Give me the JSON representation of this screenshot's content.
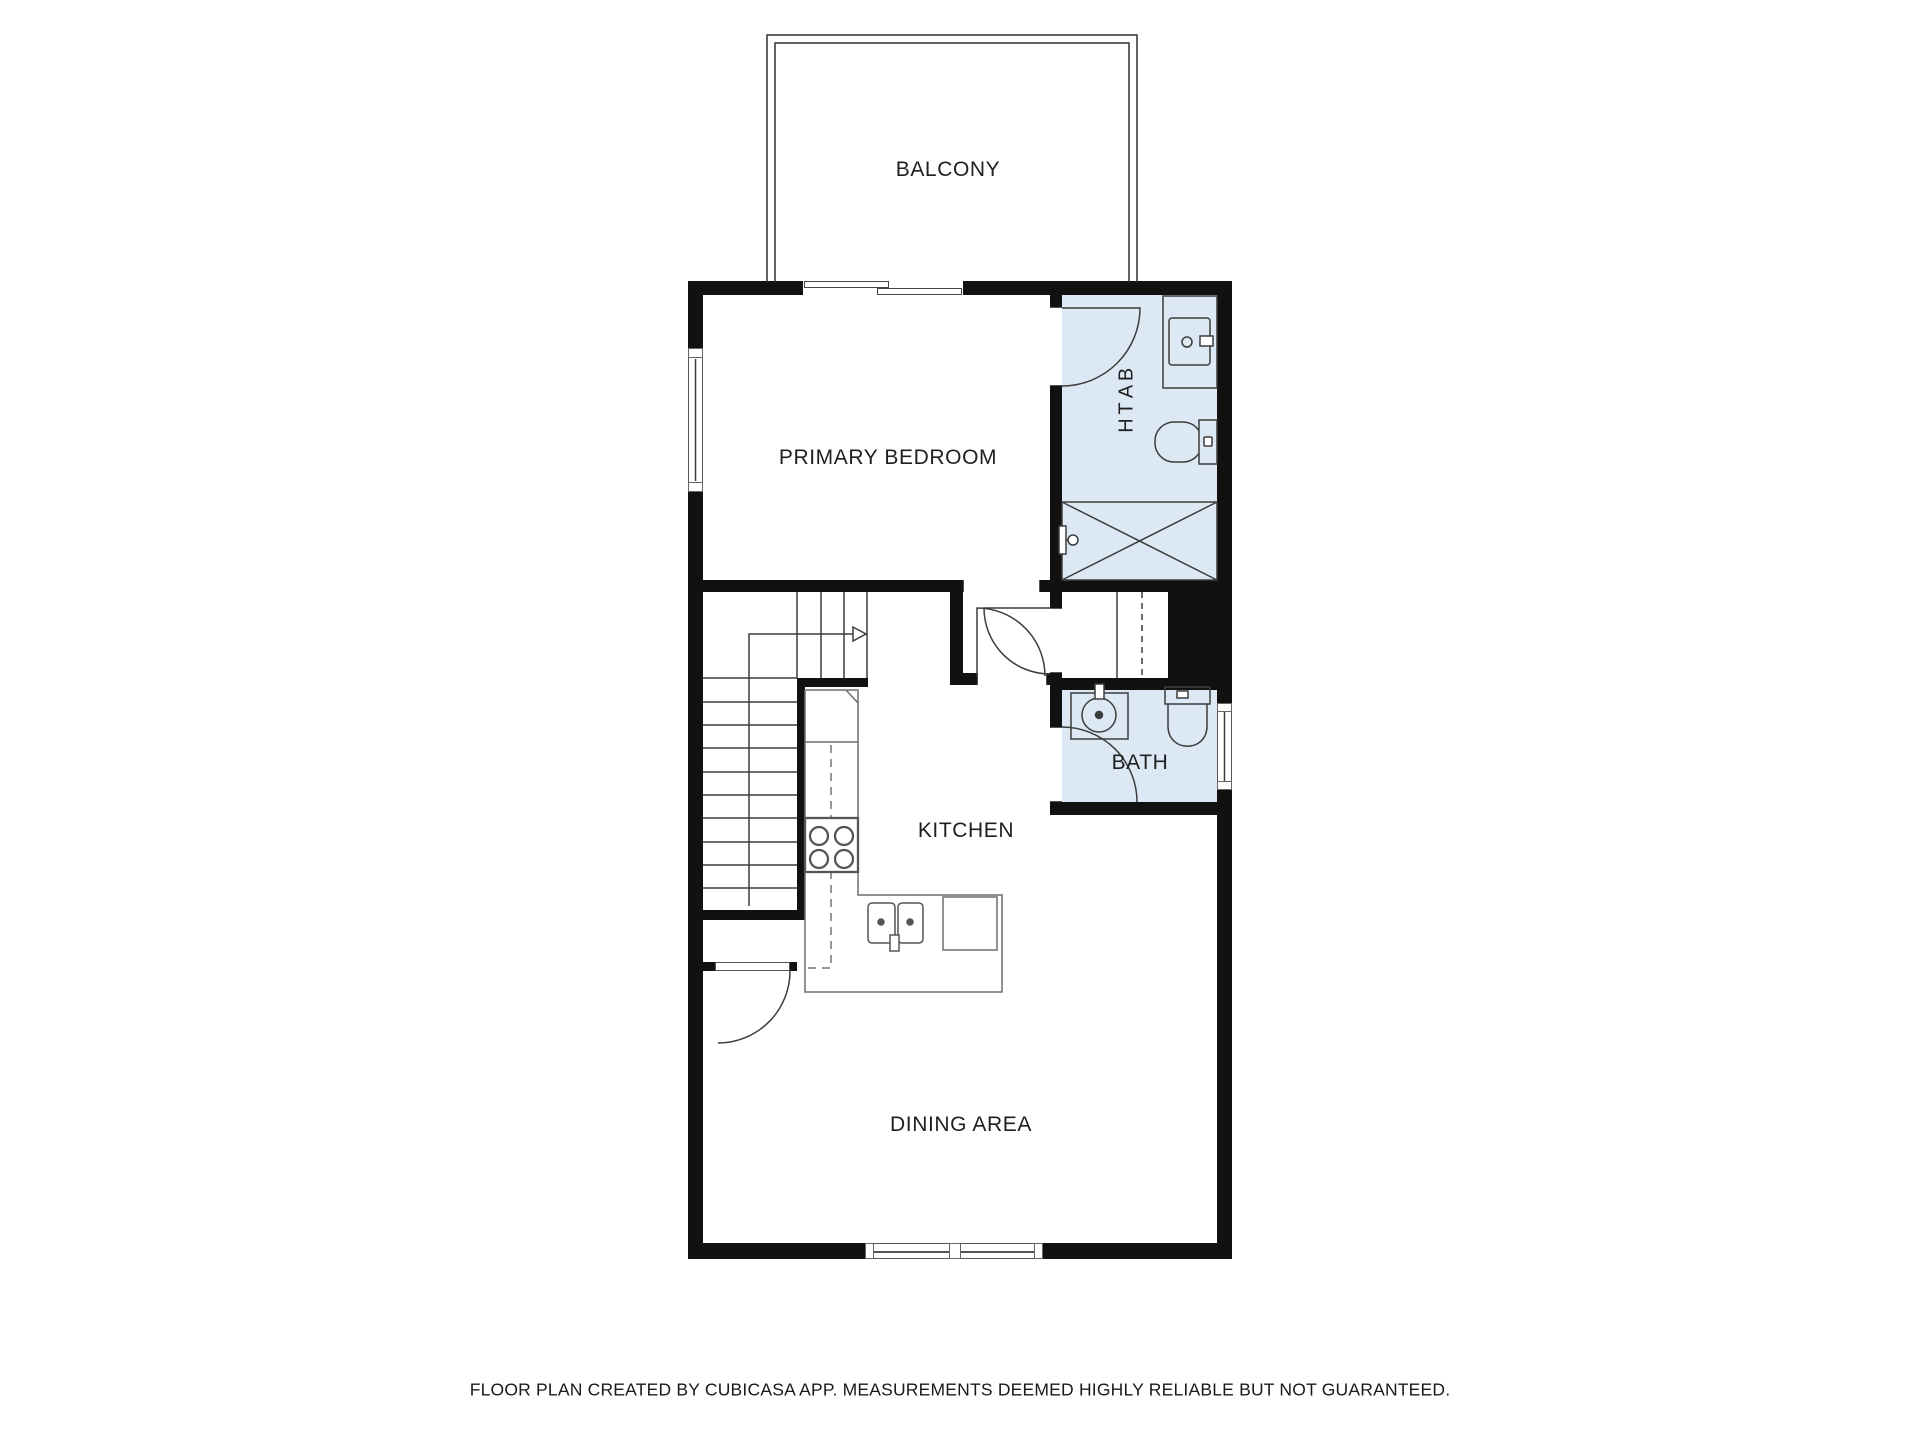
{
  "rooms": {
    "balcony": {
      "label": "BALCONY"
    },
    "primary_bedroom": {
      "label": "PRIMARY BEDROOM"
    },
    "bath_upper": {
      "label": "BATH"
    },
    "kitchen": {
      "label": "KITCHEN"
    },
    "bath_lower": {
      "label": "BATH"
    },
    "dining": {
      "label": "DINING AREA"
    }
  },
  "footer": {
    "disclaimer": "FLOOR PLAN CREATED BY CUBICASA APP. MEASUREMENTS DEEMED HIGHLY RELIABLE BUT NOT GUARANTEED."
  },
  "colors": {
    "wall": "#111111",
    "bath_floor": "#dce9f5",
    "fixture_line": "#3d3d3d",
    "counter_line": "#6e6e6e",
    "text": "#1f1f1f",
    "background": "#ffffff"
  },
  "fixtures": [
    "balcony-railing",
    "sliding-door",
    "window",
    "door-swing",
    "stairs",
    "stair-direction-arrow",
    "wardrobe",
    "shower",
    "shower-valve",
    "toilet",
    "sink-vanity",
    "double-sink",
    "faucet",
    "stove",
    "refrigerator",
    "kitchen-counter",
    "under-stair-closet"
  ]
}
